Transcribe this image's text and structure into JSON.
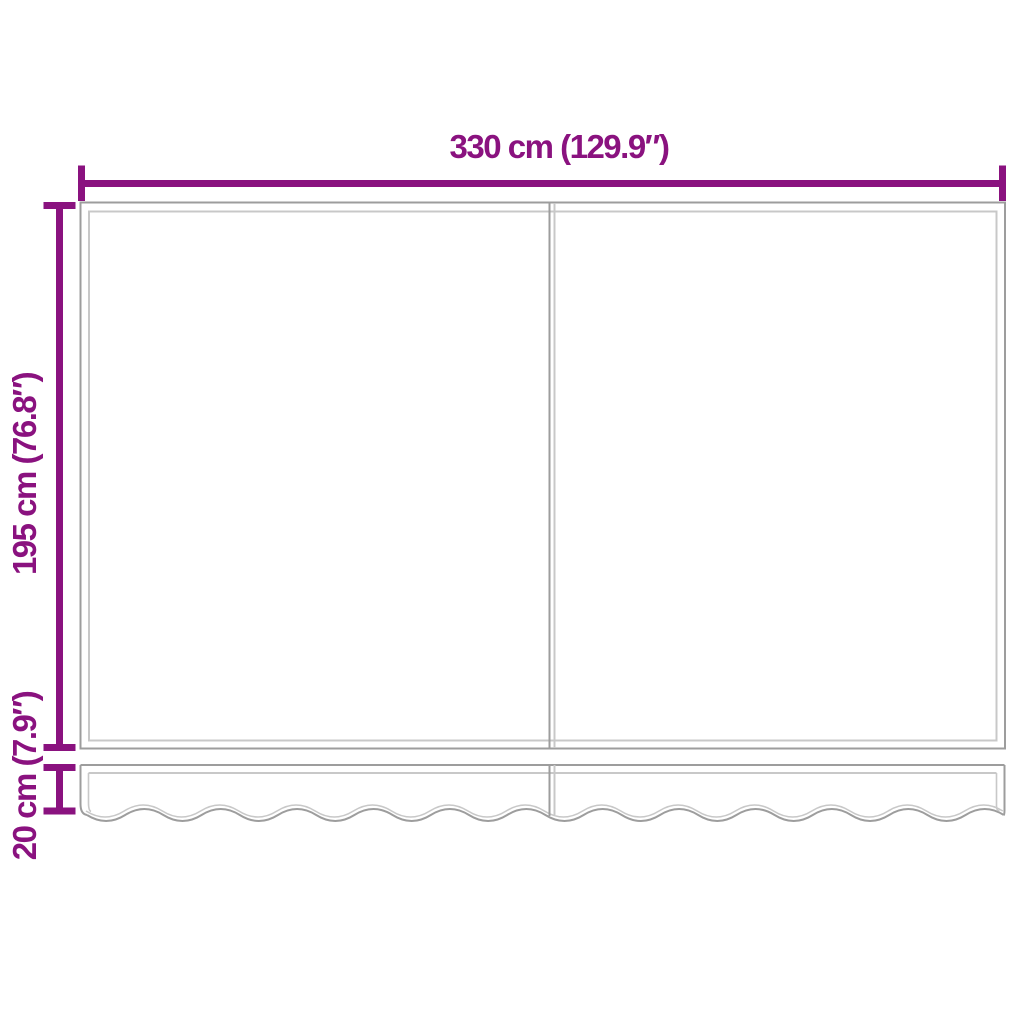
{
  "diagram": {
    "kind": "awning-replacement-fabric-dimension-diagram",
    "labels": {
      "width": "330 cm (129.9″)",
      "height": "195 cm (76.8″)",
      "valance_height": "20 cm (7.9″)"
    },
    "colors": {
      "dimension": "#8A127F",
      "outline": "#9D9D9D",
      "seam": "#C8C8C8",
      "background": "#FFFFFF"
    }
  }
}
